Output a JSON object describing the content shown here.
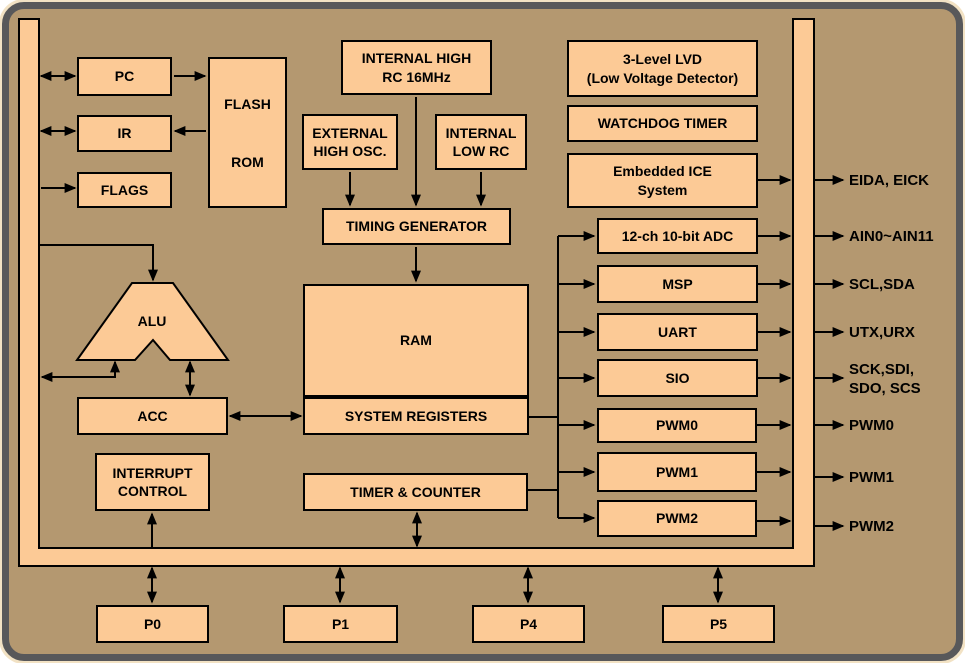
{
  "diagram_title": "Microcontroller block diagram",
  "nodes": {
    "pc": "PC",
    "ir": "IR",
    "flags": "FLAGS",
    "flash_rom": "FLASH\nROM",
    "internal_high_rc": "INTERNAL HIGH\nRC 16MHz",
    "external_high_osc": "EXTERNAL\nHIGH OSC.",
    "internal_low_rc": "INTERNAL\nLOW RC",
    "timing_generator": "TIMING GENERATOR",
    "ram": "RAM",
    "system_registers": "SYSTEM REGISTERS",
    "alu": "ALU",
    "acc": "ACC",
    "interrupt_control": "INTERRUPT\nCONTROL",
    "timer_counter": "TIMER & COUNTER",
    "lvd": "3-Level LVD\n(Low Voltage Detector)",
    "watchdog_timer": "WATCHDOG TIMER",
    "embedded_ice": "Embedded ICE\nSystem",
    "adc": "12-ch 10-bit ADC",
    "msp": "MSP",
    "uart": "UART",
    "sio": "SIO",
    "pwm0": "PWM0",
    "pwm1": "PWM1",
    "pwm2": "PWM2",
    "p0": "P0",
    "p1": "P1",
    "p4": "P4",
    "p5": "P5"
  },
  "pins": {
    "eida_eick": "EIDA, EICK",
    "ain": "AIN0~AIN11",
    "scl_sda": "SCL,SDA",
    "utx_urx": "UTX,URX",
    "spi": "SCK,SDI,\nSDO, SCS",
    "pwm0": "PWM0",
    "pwm1": "PWM1",
    "pwm2": "PWM2"
  },
  "colors": {
    "background_tan": "#B49870",
    "block_fill": "#FCCA96",
    "line_black": "#000000",
    "outer_frame_gray": "#58585A",
    "outer_edge_cream": "#F2E2C4"
  }
}
